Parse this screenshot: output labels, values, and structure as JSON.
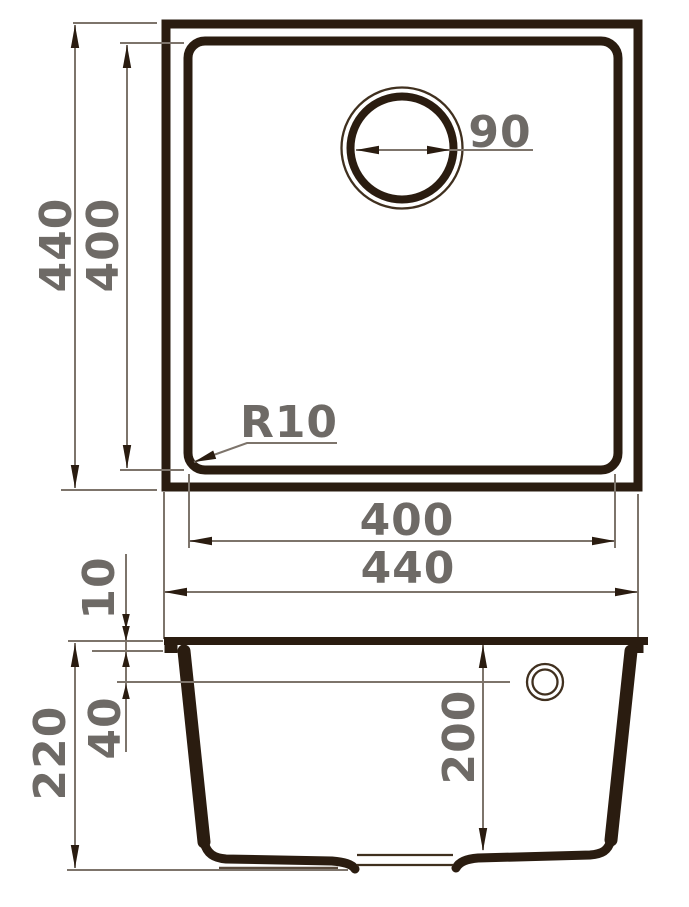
{
  "drawing": {
    "colors": {
      "line_dark": "#2a1c10",
      "line_thin": "#40301f",
      "dimension_line": "#7d746b",
      "label_text": "#6e6a66",
      "background": "#ffffff"
    },
    "top_view": {
      "outer_height": "440",
      "inner_height": "400",
      "drain_diameter": "90",
      "corner_radius": "R10",
      "inner_width": "400",
      "outer_width": "440"
    },
    "side_view": {
      "rim_thickness": "10",
      "overall_height": "220",
      "overflow_offset": "40",
      "bowl_depth": "200"
    }
  }
}
